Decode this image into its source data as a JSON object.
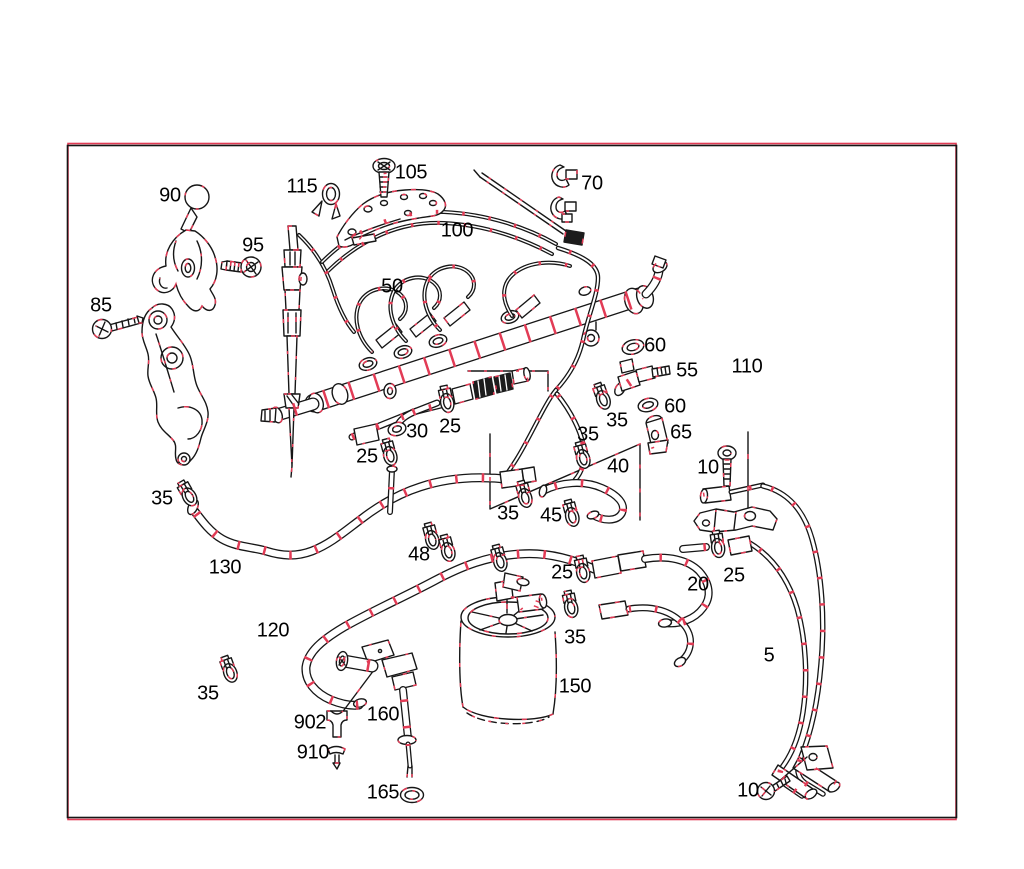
{
  "diagram": {
    "type": "exploded-parts-diagram",
    "background": "#ffffff",
    "ink_color": "#161616",
    "highlight_color": "#e23b55",
    "frame": {
      "inner_stroke": "#161616",
      "outer_stroke": "#e23b55"
    },
    "labels": [
      {
        "text": "105",
        "x": 411,
        "y": 173
      },
      {
        "text": "70",
        "x": 592,
        "y": 184
      },
      {
        "text": "115",
        "x": 302,
        "y": 187
      },
      {
        "text": "90",
        "x": 170,
        "y": 196
      },
      {
        "text": "100",
        "x": 457,
        "y": 231
      },
      {
        "text": "95",
        "x": 253,
        "y": 246
      },
      {
        "text": "50",
        "x": 392,
        "y": 287
      },
      {
        "text": "85",
        "x": 101,
        "y": 306
      },
      {
        "text": "60",
        "x": 655,
        "y": 346
      },
      {
        "text": "55",
        "x": 687,
        "y": 371
      },
      {
        "text": "110",
        "x": 747,
        "y": 367
      },
      {
        "text": "60",
        "x": 675,
        "y": 407
      },
      {
        "text": "35",
        "x": 617,
        "y": 421
      },
      {
        "text": "25",
        "x": 450,
        "y": 427
      },
      {
        "text": "30",
        "x": 417,
        "y": 432
      },
      {
        "text": "65",
        "x": 681,
        "y": 433
      },
      {
        "text": "35",
        "x": 588,
        "y": 435
      },
      {
        "text": "25",
        "x": 367,
        "y": 457
      },
      {
        "text": "40",
        "x": 618,
        "y": 467
      },
      {
        "text": "10",
        "x": 708,
        "y": 468
      },
      {
        "text": "35",
        "x": 162,
        "y": 499
      },
      {
        "text": "35",
        "x": 508,
        "y": 514
      },
      {
        "text": "45",
        "x": 551,
        "y": 516
      },
      {
        "text": "48",
        "x": 419,
        "y": 555
      },
      {
        "text": "130",
        "x": 225,
        "y": 568
      },
      {
        "text": "25",
        "x": 562,
        "y": 573
      },
      {
        "text": "25",
        "x": 734,
        "y": 576
      },
      {
        "text": "20",
        "x": 698,
        "y": 585
      },
      {
        "text": "120",
        "x": 273,
        "y": 631
      },
      {
        "text": "35",
        "x": 575,
        "y": 638
      },
      {
        "text": "5",
        "x": 769,
        "y": 656
      },
      {
        "text": "150",
        "x": 575,
        "y": 687
      },
      {
        "text": "35",
        "x": 208,
        "y": 694
      },
      {
        "text": "160",
        "x": 383,
        "y": 715
      },
      {
        "text": "902",
        "x": 310,
        "y": 723
      },
      {
        "text": "910",
        "x": 313,
        "y": 753
      },
      {
        "text": "10",
        "x": 748,
        "y": 791
      },
      {
        "text": "165",
        "x": 383,
        "y": 793
      }
    ]
  }
}
